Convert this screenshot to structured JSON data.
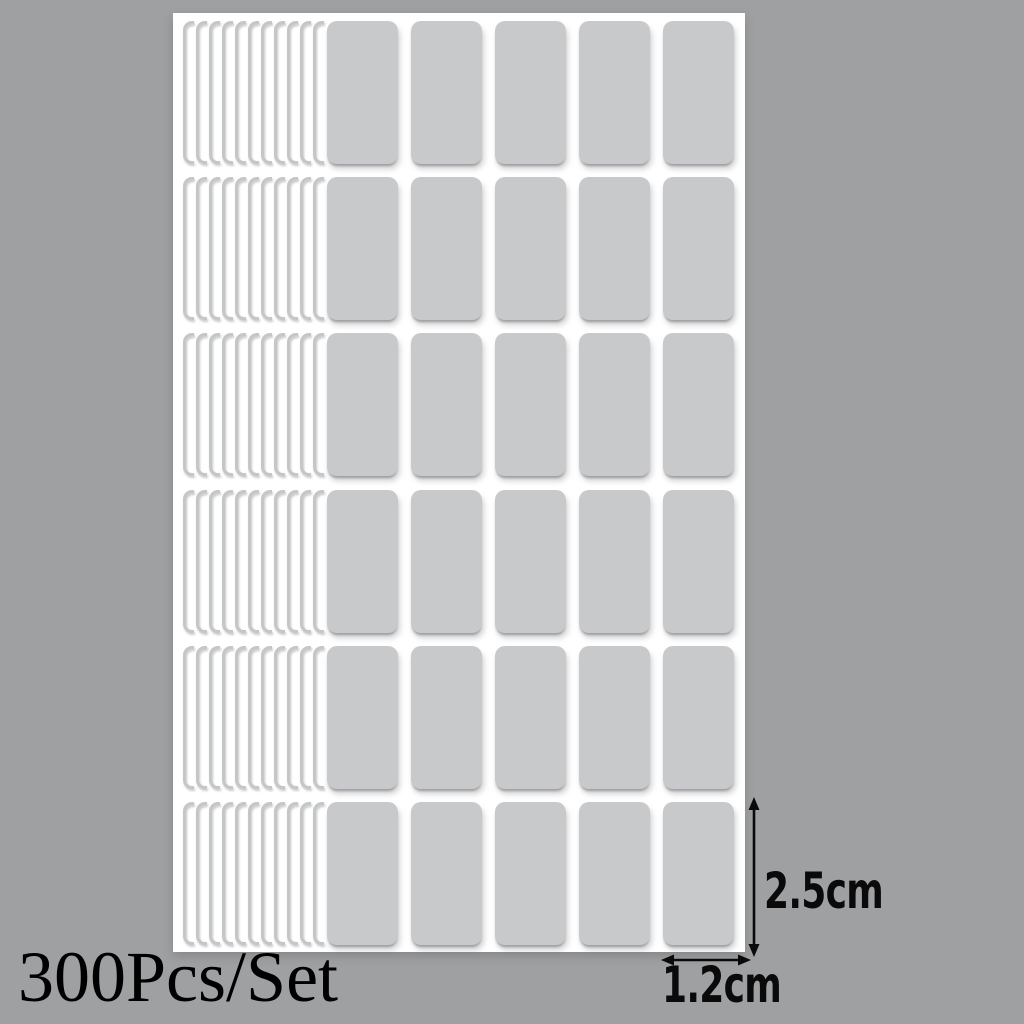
{
  "labels": {
    "set_count": "300Pcs/Set",
    "sticker_height": "2.5cm",
    "sticker_width": "1.2cm"
  },
  "sheet": {
    "rows": 6,
    "columns": 5,
    "back_sheet_edges_per_row": 11
  },
  "colors": {
    "background": "#9fa0a2",
    "sheet": "#ffffff",
    "sticker": "#c7c9cb",
    "sticker_edge": "#c4c6c8",
    "annotation": "#0a0a0a"
  }
}
